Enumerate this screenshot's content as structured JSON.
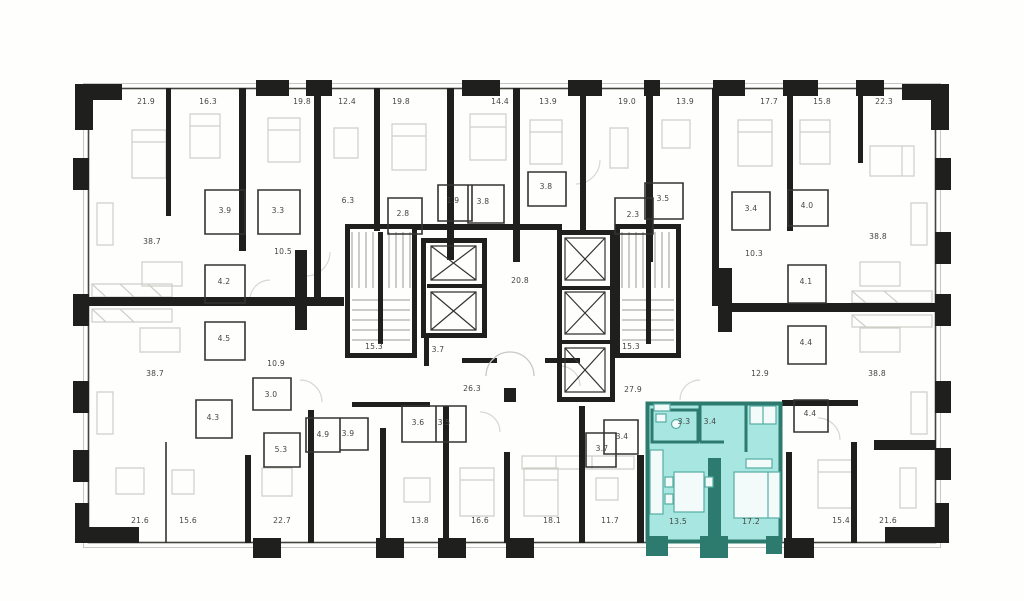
{
  "floorplan": {
    "type": "building-storey-plan",
    "wall_color": "#1f1f1d",
    "thin_wall_color": "#3a3833",
    "furniture_color": "#cfcfc8",
    "highlight_fill_color": "#a8e7e1",
    "highlight_wall_color": "#2d7a6f",
    "label_color": "#46453f",
    "highlighted_unit": {
      "room_areas": [
        "3.3",
        "3.4",
        "13.5",
        "17.2"
      ],
      "total_rooms": 4
    },
    "area_labels": [
      {
        "t": "21.9",
        "x": 146,
        "y": 104
      },
      {
        "t": "16.3",
        "x": 208,
        "y": 104
      },
      {
        "t": "19.8",
        "x": 302,
        "y": 104
      },
      {
        "t": "12.4",
        "x": 347,
        "y": 104
      },
      {
        "t": "19.8",
        "x": 401,
        "y": 104
      },
      {
        "t": "14.4",
        "x": 500,
        "y": 104
      },
      {
        "t": "13.9",
        "x": 548,
        "y": 104
      },
      {
        "t": "19.0",
        "x": 627,
        "y": 104
      },
      {
        "t": "13.9",
        "x": 685,
        "y": 104
      },
      {
        "t": "17.7",
        "x": 769,
        "y": 104
      },
      {
        "t": "15.8",
        "x": 822,
        "y": 104
      },
      {
        "t": "22.3",
        "x": 884,
        "y": 104
      },
      {
        "t": "3.9",
        "x": 225,
        "y": 213
      },
      {
        "t": "3.3",
        "x": 278,
        "y": 213
      },
      {
        "t": "6.3",
        "x": 348,
        "y": 203
      },
      {
        "t": "2.8",
        "x": 403,
        "y": 216
      },
      {
        "t": "1.9",
        "x": 453,
        "y": 203
      },
      {
        "t": "3.8",
        "x": 483,
        "y": 204
      },
      {
        "t": "3.8",
        "x": 546,
        "y": 189
      },
      {
        "t": "2.3",
        "x": 633,
        "y": 217
      },
      {
        "t": "3.5",
        "x": 663,
        "y": 201
      },
      {
        "t": "3.4",
        "x": 751,
        "y": 211
      },
      {
        "t": "4.0",
        "x": 807,
        "y": 208
      },
      {
        "t": "38.7",
        "x": 152,
        "y": 244
      },
      {
        "t": "38.8",
        "x": 878,
        "y": 239
      },
      {
        "t": "10.5",
        "x": 283,
        "y": 254
      },
      {
        "t": "10.3",
        "x": 754,
        "y": 256
      },
      {
        "t": "4.2",
        "x": 224,
        "y": 284
      },
      {
        "t": "4.5",
        "x": 224,
        "y": 341
      },
      {
        "t": "20.8",
        "x": 520,
        "y": 283
      },
      {
        "t": "4.1",
        "x": 806,
        "y": 284
      },
      {
        "t": "4.4",
        "x": 806,
        "y": 345
      },
      {
        "t": "15.3",
        "x": 374,
        "y": 349
      },
      {
        "t": "3.7",
        "x": 438,
        "y": 352
      },
      {
        "t": "15.3",
        "x": 631,
        "y": 349
      },
      {
        "t": "10.9",
        "x": 276,
        "y": 366
      },
      {
        "t": "12.9",
        "x": 760,
        "y": 376
      },
      {
        "t": "38.7",
        "x": 155,
        "y": 376
      },
      {
        "t": "38.8",
        "x": 877,
        "y": 376
      },
      {
        "t": "26.3",
        "x": 472,
        "y": 391
      },
      {
        "t": "27.9",
        "x": 633,
        "y": 392
      },
      {
        "t": "3.0",
        "x": 271,
        "y": 397
      },
      {
        "t": "4.3",
        "x": 213,
        "y": 420
      },
      {
        "t": "3.6",
        "x": 418,
        "y": 425
      },
      {
        "t": "3.5",
        "x": 444,
        "y": 425
      },
      {
        "t": "4.9",
        "x": 323,
        "y": 437
      },
      {
        "t": "3.9",
        "x": 348,
        "y": 436
      },
      {
        "t": "5.3",
        "x": 281,
        "y": 452
      },
      {
        "t": "3.7",
        "x": 602,
        "y": 451
      },
      {
        "t": "3.4",
        "x": 622,
        "y": 439
      },
      {
        "t": "3.3",
        "x": 684,
        "y": 424
      },
      {
        "t": "3.4",
        "x": 710,
        "y": 424
      },
      {
        "t": "4.4",
        "x": 810,
        "y": 416
      },
      {
        "t": "21.6",
        "x": 140,
        "y": 523
      },
      {
        "t": "15.6",
        "x": 188,
        "y": 523
      },
      {
        "t": "22.7",
        "x": 282,
        "y": 523
      },
      {
        "t": "13.8",
        "x": 420,
        "y": 523
      },
      {
        "t": "16.6",
        "x": 480,
        "y": 523
      },
      {
        "t": "18.1",
        "x": 552,
        "y": 523
      },
      {
        "t": "11.7",
        "x": 610,
        "y": 523
      },
      {
        "t": "13.5",
        "x": 678,
        "y": 524
      },
      {
        "t": "17.2",
        "x": 751,
        "y": 524
      },
      {
        "t": "15.4",
        "x": 841,
        "y": 523
      },
      {
        "t": "21.6",
        "x": 888,
        "y": 523
      }
    ]
  }
}
